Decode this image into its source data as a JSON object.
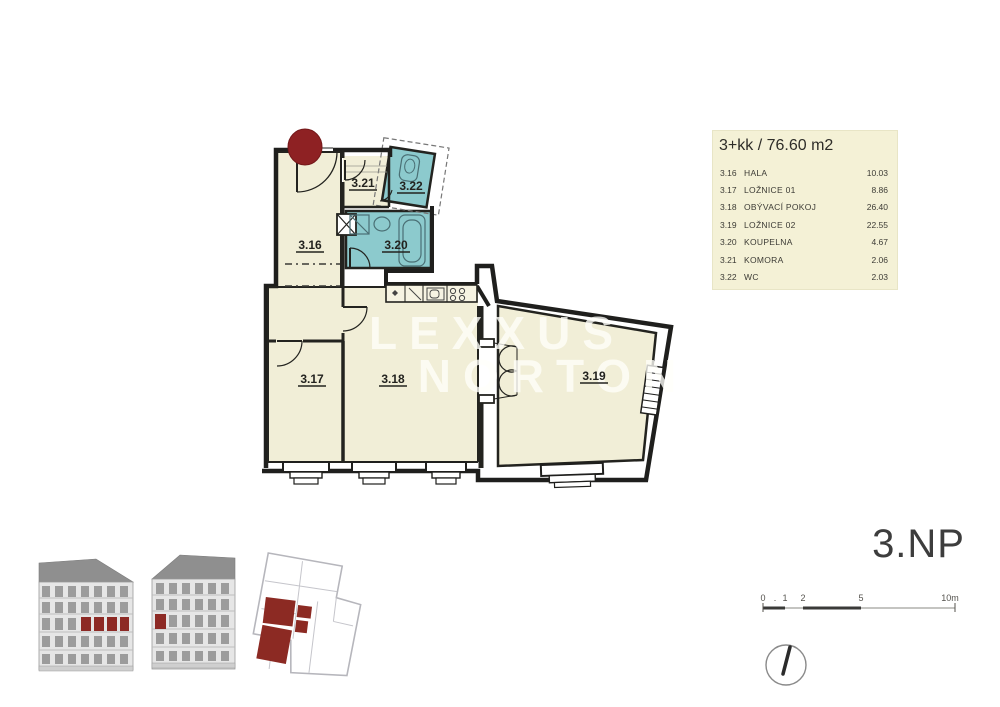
{
  "legend": {
    "title": "3+kk / 76.60 m2",
    "rows": [
      {
        "code": "3.16",
        "name": "HALA",
        "area": "10.03"
      },
      {
        "code": "3.17",
        "name": "LOŽNICE 01",
        "area": "8.86"
      },
      {
        "code": "3.18",
        "name": "OBÝVACÍ POKOJ",
        "area": "26.40"
      },
      {
        "code": "3.19",
        "name": "LOŽNICE 02",
        "area": "22.55"
      },
      {
        "code": "3.20",
        "name": "KOUPELNA",
        "area": "4.67"
      },
      {
        "code": "3.21",
        "name": "KOMORA",
        "area": "2.06"
      },
      {
        "code": "3.22",
        "name": "WC",
        "area": "2.03"
      }
    ]
  },
  "floor_label": "3.NP",
  "watermark": {
    "line1": "LEXXUS",
    "line2": "NORTON"
  },
  "plan": {
    "room_labels": {
      "r316": "3.16",
      "r317": "3.17",
      "r318": "3.18",
      "r319": "3.19",
      "r320": "3.20",
      "r321": "3.21",
      "r322": "3.22"
    }
  },
  "scale_bar": {
    "ticks": [
      "0",
      ".",
      "1",
      "2",
      "5",
      "10m"
    ]
  },
  "colors": {
    "room_cream": "#f1eed7",
    "room_teal": "#8ccacd",
    "wall": "#1f1f1d",
    "highlight_red": "#8e2123",
    "legend_bg": "#f4f1d6",
    "elevation_gray": "#e6e6e6",
    "roof_gray": "#8f8f8f"
  }
}
